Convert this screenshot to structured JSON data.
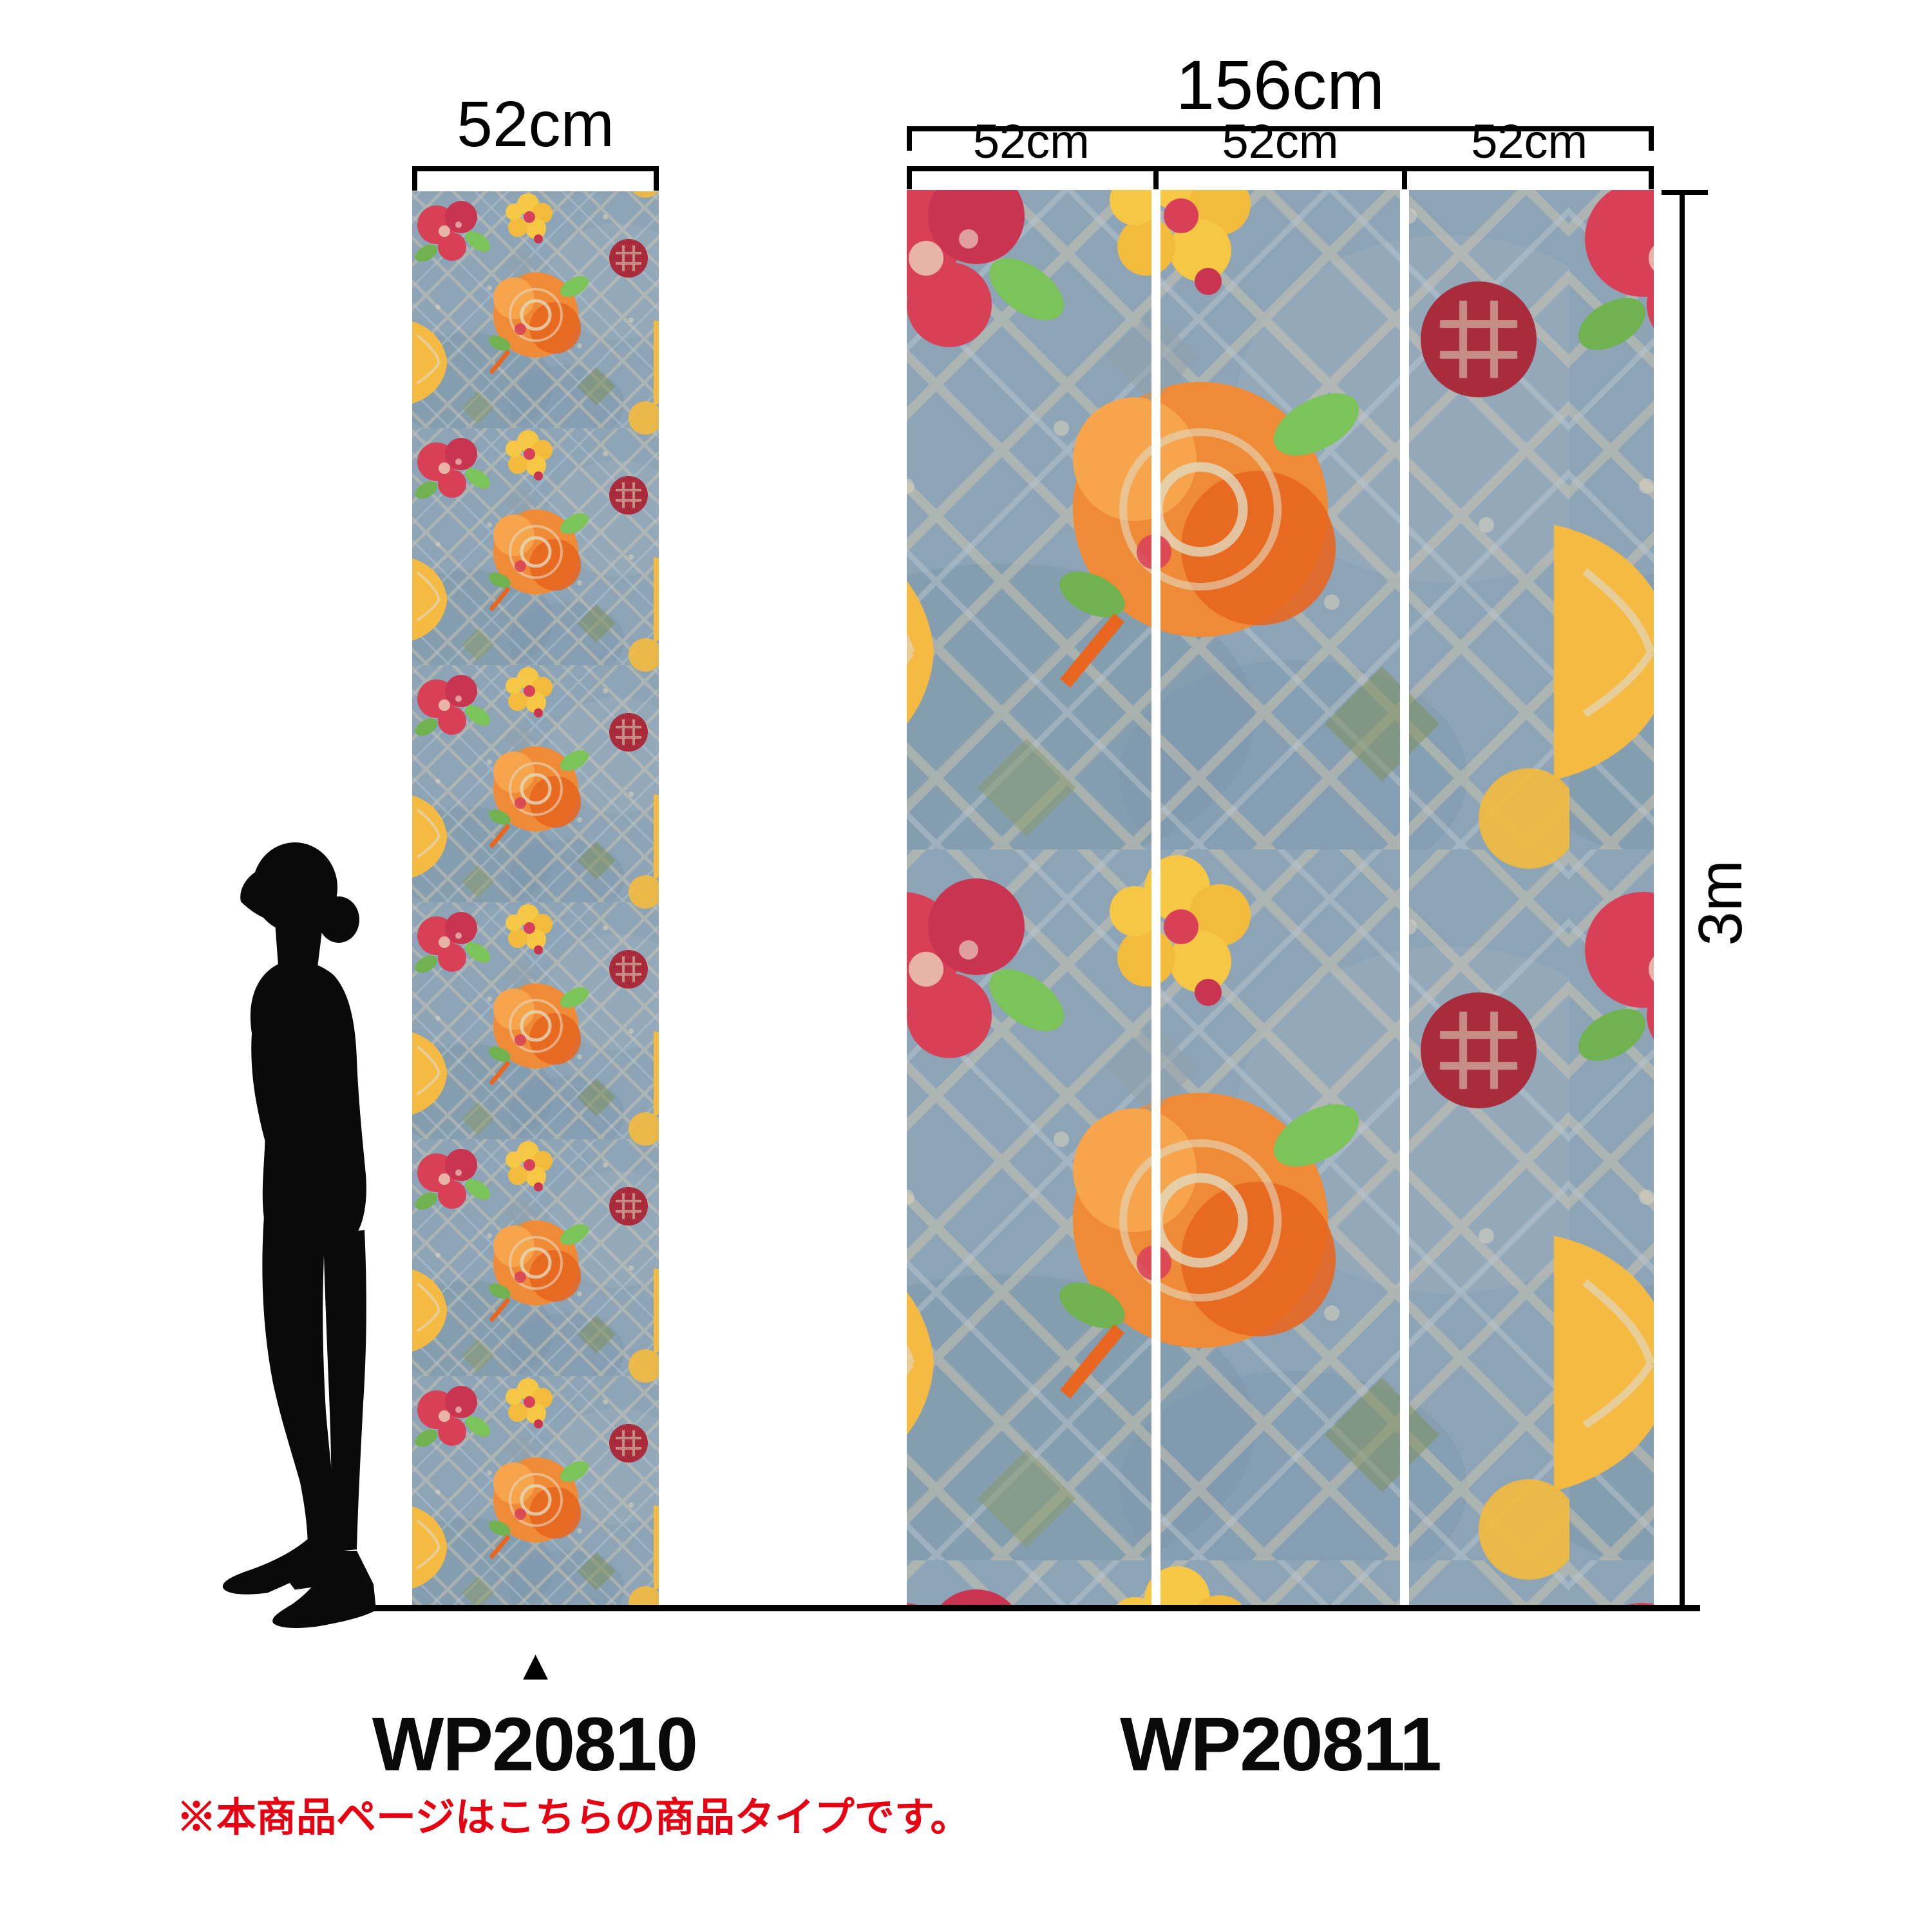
{
  "left_product": {
    "width_label": "52cm",
    "code": "WP20810"
  },
  "right_product": {
    "total_width_label": "156cm",
    "strip_labels": [
      "52cm",
      "52cm",
      "52cm"
    ],
    "code": "WP20811"
  },
  "dimensions": {
    "height_label": "3m"
  },
  "marker": {
    "symbol": "▲"
  },
  "note": {
    "text": "※本商品ページはこちらの商品タイプです。",
    "color": "#e60012"
  },
  "colors": {
    "ink": "#000000",
    "wall_blue": "#8ca4b6",
    "wall_blue_dark": "#7e96a9",
    "lattice_beige": "#cdc6b0",
    "lattice_blue": "#b9c6d0",
    "flower_orange": "#ef8b36",
    "flower_deep_orange": "#e8661f",
    "flower_yellow": "#f6c645",
    "flower_gold": "#f5ba42",
    "flower_crimson": "#d84058",
    "flower_dark_red": "#a82c3c",
    "leaf_green": "#7cc45a",
    "leaf_olive": "#7f8f5f"
  }
}
